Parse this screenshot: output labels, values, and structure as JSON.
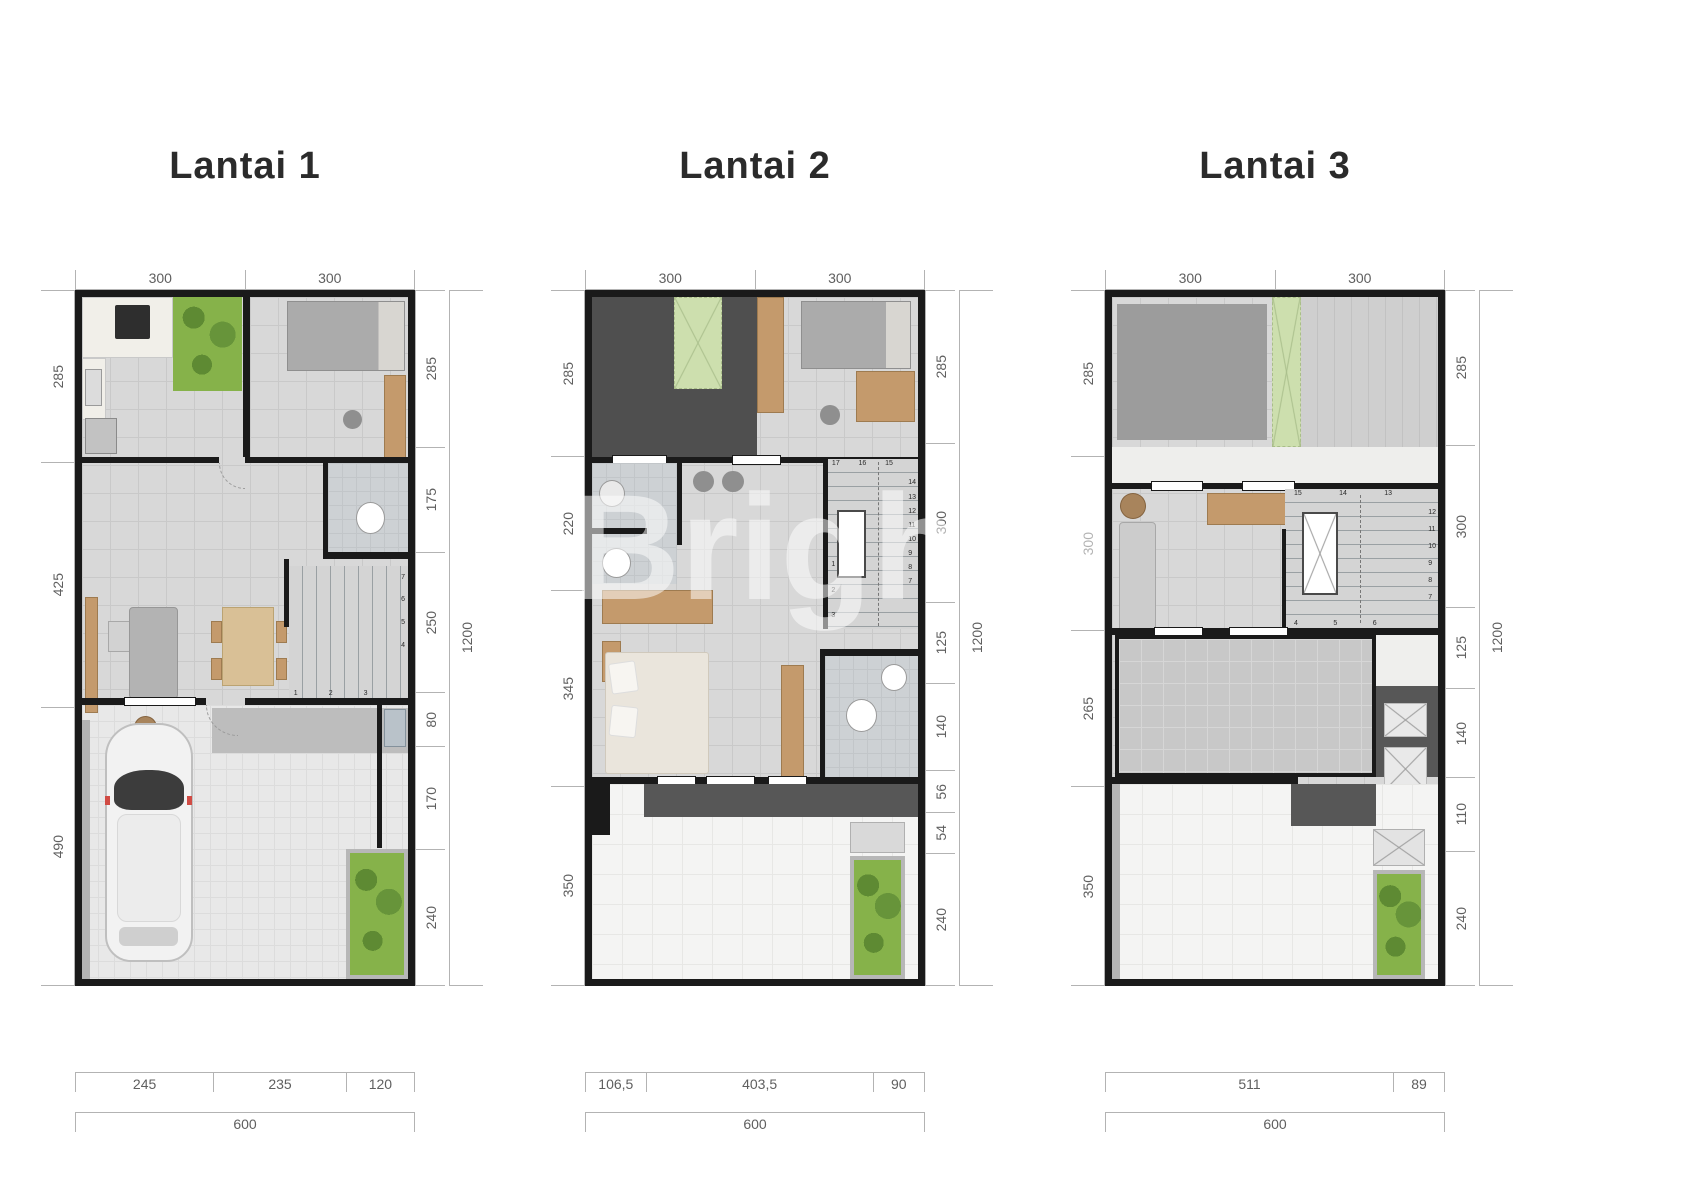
{
  "watermark": {
    "text": "Brighton"
  },
  "colors": {
    "wall": "#1a1a1a",
    "floor": "#d8d8d8",
    "garden_green": "#86b24a",
    "pale_green": "#cddfae",
    "wood": "#c49a6c",
    "dark_zone": "#4f4f4f",
    "dim_line": "#b3b3b3",
    "dim_text": "#5f5f5f",
    "title_text": "#2b2b2b",
    "dark_band": "#575757",
    "bath_floor": "#cdd1d4",
    "roof_white": "#f4f4f3",
    "terrace_gray": "#c8c8c8",
    "car_white": "#f2f2f2"
  },
  "plans": [
    {
      "title": "Lantai 1",
      "dims": {
        "top": [
          "300",
          "300"
        ],
        "left": [
          "285",
          "425",
          "490"
        ],
        "right": [
          "285",
          "175",
          "250",
          "80",
          "170",
          "240"
        ],
        "right_total": "1200",
        "bottom": [
          "245",
          "235",
          "120"
        ],
        "bottom_total": "600"
      },
      "stairs": {
        "bottom": [
          "1",
          "2",
          "3"
        ],
        "side": [
          "7",
          "6",
          "5",
          "4"
        ]
      }
    },
    {
      "title": "Lantai 2",
      "dims": {
        "top": [
          "300",
          "300"
        ],
        "left": [
          "285",
          "220",
          "345",
          "350"
        ],
        "right": [
          "285",
          "300",
          "125",
          "140",
          "56",
          "54",
          "240"
        ],
        "right_total": "1200",
        "bottom": [
          "106,5",
          "403,5",
          "90"
        ],
        "bottom_total": "600"
      },
      "stairs": {
        "top": [
          "17",
          "16",
          "15"
        ],
        "side": [
          "14",
          "13",
          "12",
          "11",
          "10",
          "9",
          "8",
          "7"
        ],
        "bottom": [
          "1",
          "2",
          "3"
        ]
      }
    },
    {
      "title": "Lantai 3",
      "dims": {
        "top": [
          "300",
          "300"
        ],
        "left": [
          "285",
          "300",
          "265",
          "350"
        ],
        "right": [
          "285",
          "300",
          "125",
          "140",
          "110",
          "240"
        ],
        "right_total": "1200",
        "bottom": [
          "511",
          "89"
        ],
        "bottom_total": "600"
      },
      "stairs": {
        "top": [
          "15",
          "14",
          "13"
        ],
        "side": [
          "12",
          "11",
          "10",
          "9",
          "8",
          "7"
        ],
        "bottom": [
          "4",
          "5",
          "6"
        ]
      }
    }
  ]
}
